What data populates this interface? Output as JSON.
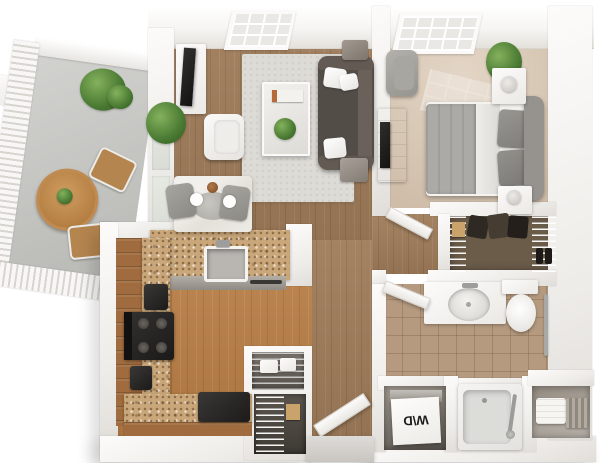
{
  "scene": {
    "title": "3D floor plan render — one-bedroom apartment with balcony",
    "labels": {
      "washer_dryer": "W\\D"
    },
    "rooms": [
      {
        "id": "balcony",
        "name": "Balcony"
      },
      {
        "id": "living-room",
        "name": "Living Room"
      },
      {
        "id": "dining-area",
        "name": "Dining Area"
      },
      {
        "id": "kitchen",
        "name": "Kitchen"
      },
      {
        "id": "pantry",
        "name": "Pantry"
      },
      {
        "id": "entry",
        "name": "Entry"
      },
      {
        "id": "hallway",
        "name": "Hallway"
      },
      {
        "id": "bedroom",
        "name": "Bedroom"
      },
      {
        "id": "walk-in-closet",
        "name": "Walk-in Closet"
      },
      {
        "id": "bathroom",
        "name": "Bathroom"
      },
      {
        "id": "laundry",
        "name": "Washer / Dryer Closet"
      },
      {
        "id": "linen-closet",
        "name": "Linen Closet"
      }
    ]
  },
  "colors": {
    "wood": "#9e7b59",
    "kitchen-floor": "#b97e45",
    "carpet": "#dac7b2",
    "closet-floor": "#6b5c4a",
    "tile": "#b59a7f",
    "granite": "#c9a77a",
    "cabinet-wood": "#a06c3f",
    "concrete": "#c8c8c5",
    "rug": "#dcdbd6",
    "sofa": "#534d48",
    "marble": "#edebe6",
    "white-furniture": "#f6f5f2",
    "plant-green": "#4e7d33",
    "dark-appliance": "#232120",
    "wall-face": "#f1efec",
    "table-wood": "#bf8a50",
    "grey-chair": "#9b9994",
    "duvet-grey": "#abaaa7",
    "tub-grey": "#dcdcd9"
  }
}
